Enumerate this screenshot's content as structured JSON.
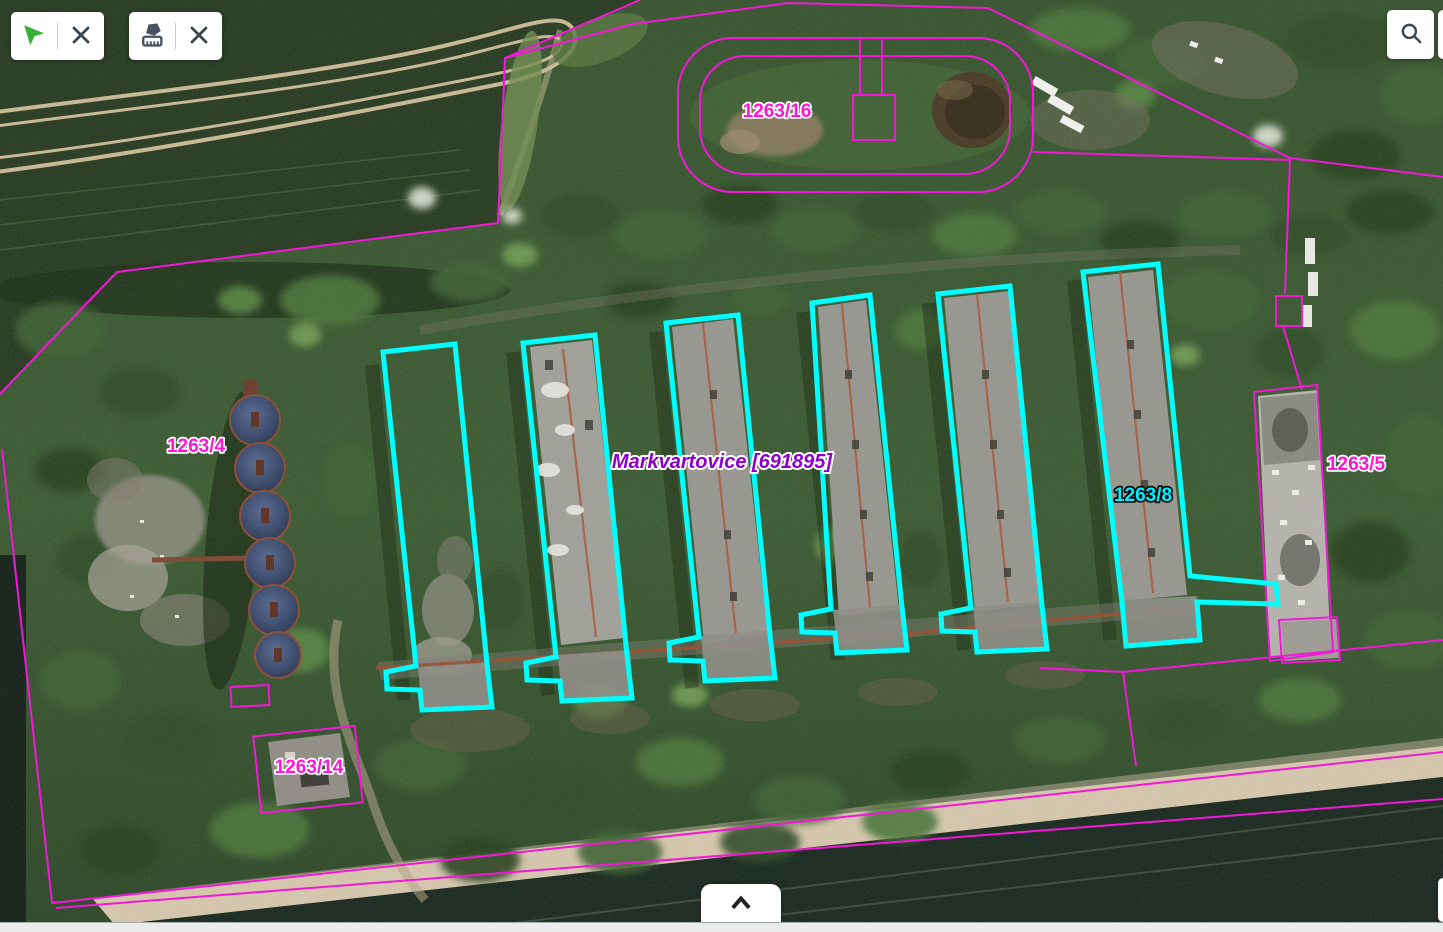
{
  "toolbar": {
    "selection_group": {
      "buttons": [
        {
          "icon": "cursor-icon"
        },
        {
          "icon": "close-icon"
        }
      ]
    },
    "measure_group": {
      "buttons": [
        {
          "icon": "measure-area-icon"
        },
        {
          "icon": "close-icon"
        }
      ]
    },
    "search_group": {
      "buttons": [
        {
          "icon": "search-icon"
        }
      ]
    },
    "bottom_panel": {
      "expand_icon": "chevron-up-icon"
    }
  },
  "map": {
    "municipality_label": "Markvartovice [691895]",
    "parcel_labels": [
      {
        "text": "1263/16",
        "kind": "boundary"
      },
      {
        "text": "1263/4",
        "kind": "boundary"
      },
      {
        "text": "1263/8",
        "kind": "selected"
      },
      {
        "text": "1263/5",
        "kind": "boundary"
      },
      {
        "text": "1263/14",
        "kind": "boundary"
      }
    ],
    "colors": {
      "parcel_boundary_line": "#f218d8",
      "selected_parcel_line": "#00ffff",
      "boundary_label_color": "#ff14d8",
      "selected_label_color": "#00f0ff",
      "municipality_label_color": "#8d00cc"
    }
  }
}
